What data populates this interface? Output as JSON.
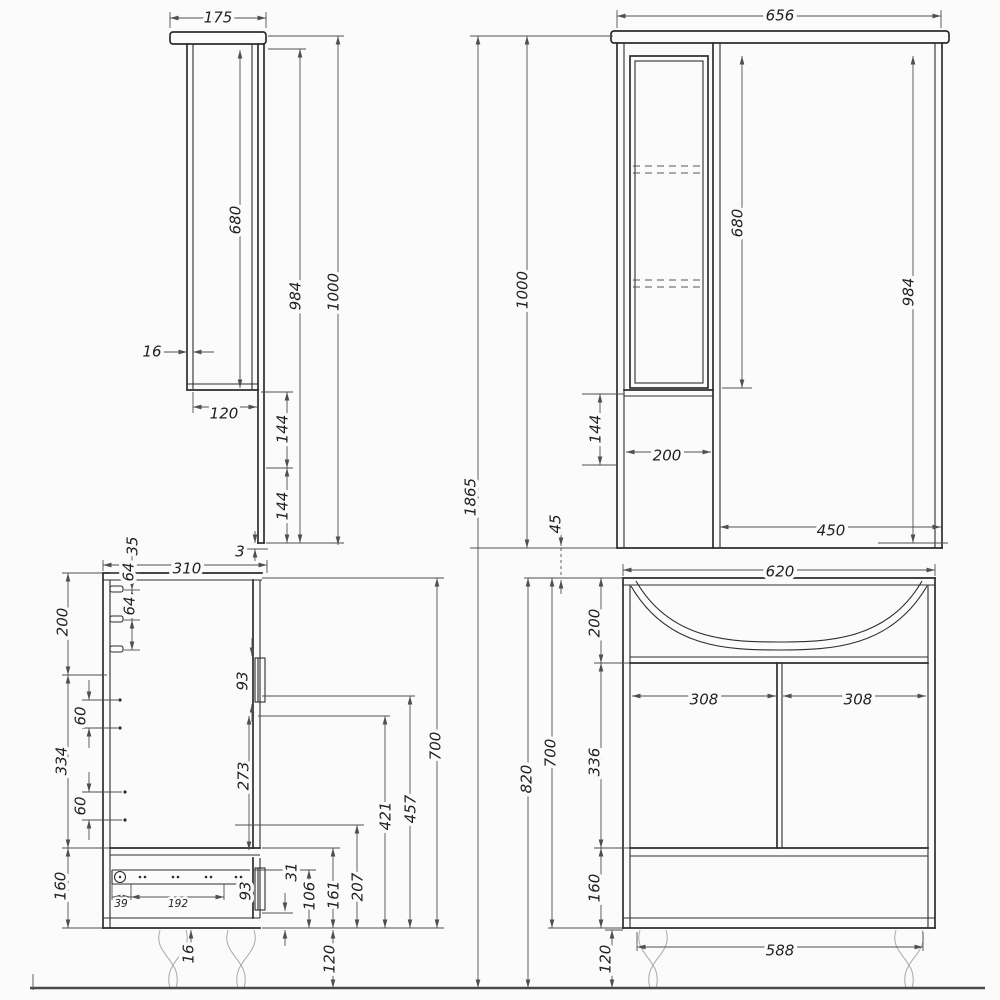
{
  "drawing": {
    "title": "bathroom furniture set technical drawing",
    "views": {
      "mirror_side": "mirror cabinet side view",
      "mirror_front": "mirror cabinet front view",
      "vanity_side": "vanity cabinet side view",
      "vanity_front": "vanity cabinet front view"
    },
    "colors": {
      "background": "#fbfbfb",
      "line": "#2d2d2d",
      "dimension": "#4f4f4f"
    }
  },
  "labels": {
    "overall": {
      "height": "1865"
    },
    "v1": {
      "width": "175",
      "wall": "16",
      "box": "680",
      "inner": "984",
      "total": "1000",
      "bottom": "120",
      "panel1": "144",
      "panel2": "144",
      "gap": "3"
    },
    "v2": {
      "width": "656",
      "box": "680",
      "inner": "984",
      "total": "1000",
      "lower": "144",
      "column": "200",
      "mirror": "450",
      "gap": "45"
    },
    "v3": {
      "depth": "310",
      "hook1": "35",
      "hook2": "64",
      "hook3": "64",
      "top": "200",
      "pin1": "60",
      "middle": "334",
      "pin2": "60",
      "bottom": "160",
      "door_handle": "93",
      "door": "273",
      "slide_front": "39",
      "slide_pitch": "192",
      "drawer_handle": "93",
      "panel": "16",
      "r31": "31",
      "r106": "106",
      "r161": "161",
      "r207": "207",
      "r421": "421",
      "r457": "457",
      "r700": "700",
      "legs": "120"
    },
    "v4": {
      "width": "620",
      "sink": "200",
      "doors": "336",
      "drawer": "160",
      "body": "700",
      "total": "820",
      "door_left": "308",
      "door_right": "308",
      "base": "588",
      "legs": "120"
    }
  }
}
